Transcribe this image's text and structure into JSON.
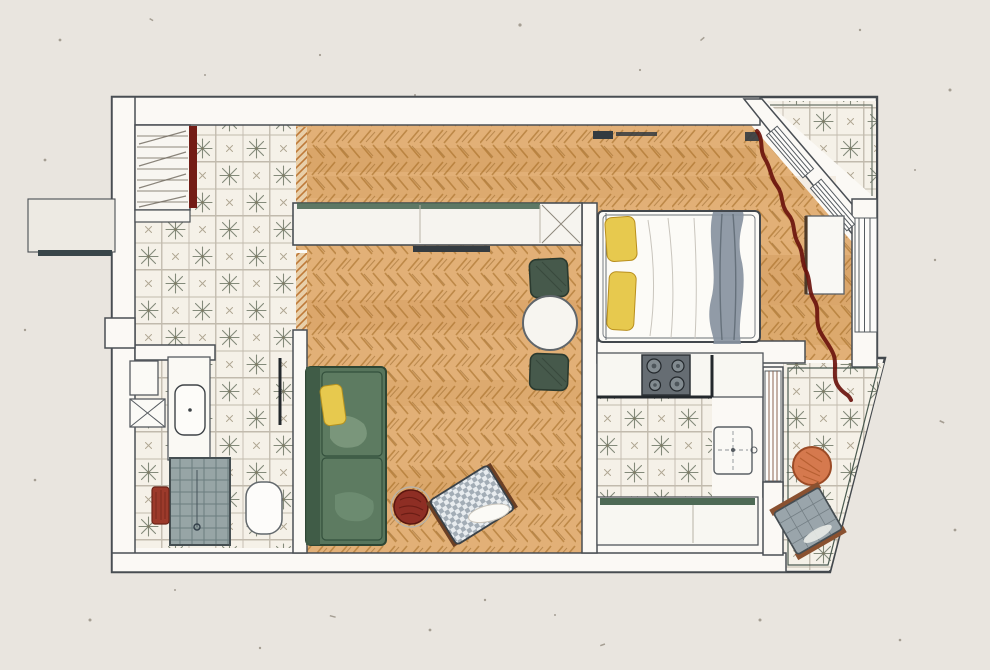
{
  "artwork": {
    "type": "hand-drawn apartment floor plan",
    "medium": "pencil and watercolor on paper",
    "orientation": "landscape"
  },
  "palette": {
    "paper": "#e9e5df",
    "wallFill": "#fbf9f5",
    "wallLine": "#43484d",
    "tileBase": "#f5f1e8",
    "tileStar": "#66705f",
    "parquetBase": "#e2b077",
    "parquetStroke": "#b5803c",
    "cabinetGreen": "#4e6a55",
    "sofaGreen": "#57755c",
    "stoolGreen": "#46594b",
    "pillowYellow": "#e7c94e",
    "curtainMaroon": "#6a140d",
    "wardrobeDoorRed": "#731c15",
    "radiatorRed": "#9c3a2b",
    "poufRed": "#8e2e24",
    "tableOrange": "#d5794e",
    "chairGray": "#9aa5ab",
    "drapeGray": "#8893a0",
    "stoveGray": "#666d73",
    "showerGray": "#97a5a6",
    "darkBar": "#343b40"
  },
  "rooms": [
    {
      "id": "entry-hall",
      "name": "Entry hall",
      "floor": "patterned cement tile"
    },
    {
      "id": "corridor",
      "name": "Corridor",
      "floor": "herringbone parquet"
    },
    {
      "id": "living-room",
      "name": "Living room",
      "floor": "herringbone parquet"
    },
    {
      "id": "dining-nook",
      "name": "Dining nook",
      "floor": "herringbone parquet"
    },
    {
      "id": "bedroom",
      "name": "Bedroom",
      "floor": "herringbone parquet"
    },
    {
      "id": "kitchen",
      "name": "Kitchen",
      "floor": "patterned cement tile"
    },
    {
      "id": "bathroom",
      "name": "Bathroom",
      "floor": "patterned cement tile"
    },
    {
      "id": "north-loggia",
      "name": "Corner loggia",
      "floor": "patterned cement tile"
    },
    {
      "id": "south-balcony",
      "name": "Balcony",
      "floor": "patterned cement tile"
    }
  ],
  "furniture": [
    {
      "room": "entry-hall",
      "item": "wardrobe with shelves and dark red sliding door"
    },
    {
      "room": "corridor",
      "item": "long built-in closet with green top edge"
    },
    {
      "room": "living-room",
      "item": "green sofa with yellow cushion"
    },
    {
      "room": "living-room",
      "item": "round red pouf"
    },
    {
      "room": "living-room",
      "item": "checkered armchair with white pillow"
    },
    {
      "room": "dining-nook",
      "item": "round table with two green stools"
    },
    {
      "room": "bedroom",
      "item": "double bed with yellow pillows and gray throw"
    },
    {
      "room": "bedroom",
      "item": "console under window"
    },
    {
      "room": "bedroom",
      "item": "wavy maroon curtain along bay windows"
    },
    {
      "room": "kitchen",
      "item": "four-burner stove in counter"
    },
    {
      "room": "kitchen",
      "item": "small island table"
    },
    {
      "room": "kitchen",
      "item": "lower counter with green edge"
    },
    {
      "room": "bathroom",
      "item": "washing machine"
    },
    {
      "room": "bathroom",
      "item": "vanity with sink"
    },
    {
      "room": "bathroom",
      "item": "gray shower tray"
    },
    {
      "room": "bathroom",
      "item": "toilet"
    },
    {
      "room": "bathroom",
      "item": "small red radiator"
    },
    {
      "room": "south-balcony",
      "item": "round orange side table"
    },
    {
      "room": "south-balcony",
      "item": "gray outdoor armchair"
    }
  ]
}
